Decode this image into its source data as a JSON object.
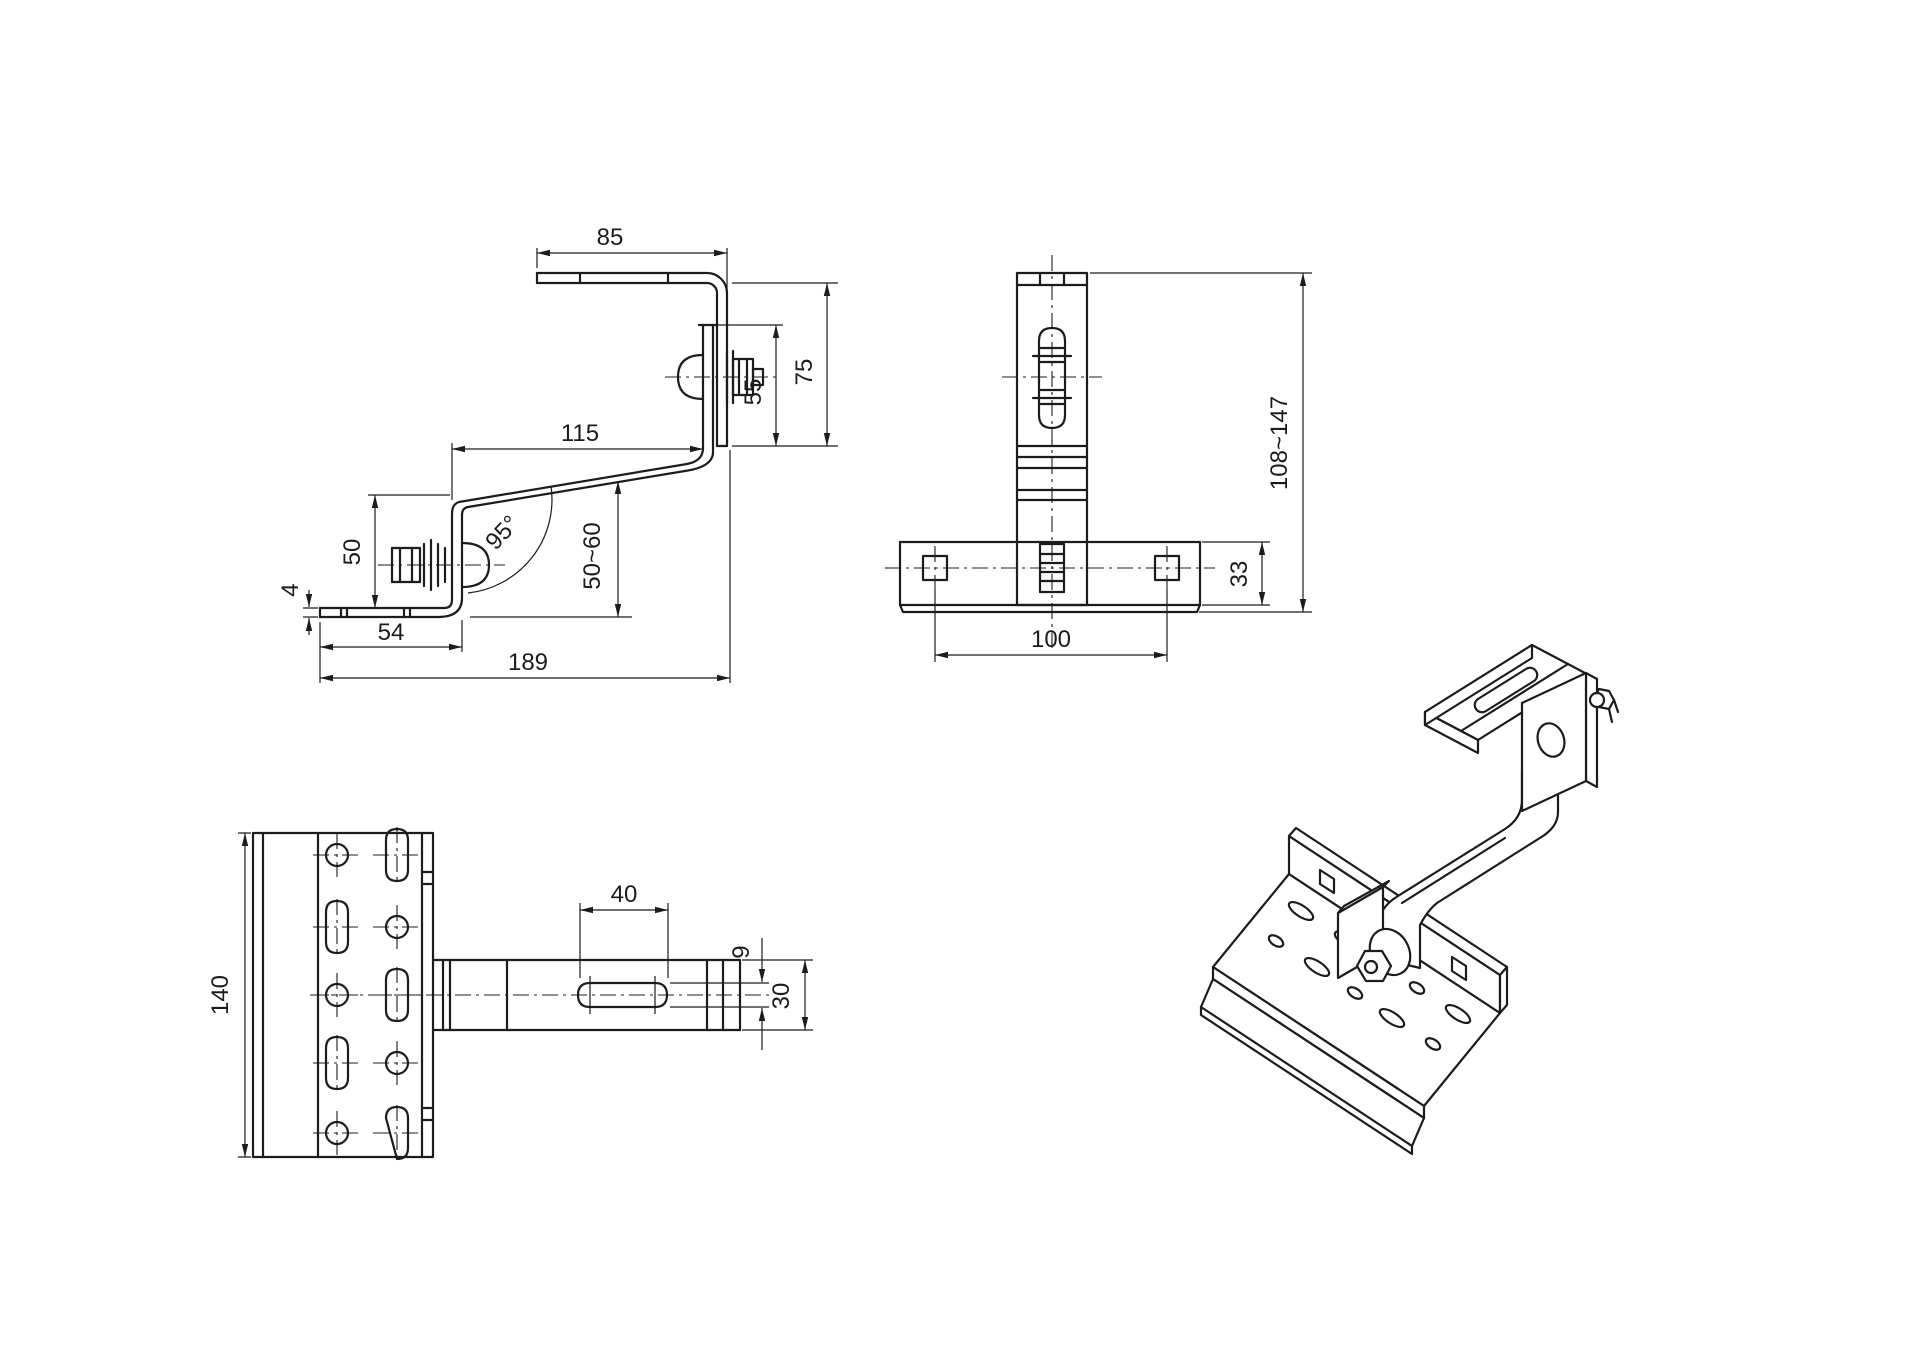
{
  "title": "roof-hook-technical-drawing",
  "colors": {
    "line": "#1c1c1c",
    "background": "#ffffff"
  },
  "dims": {
    "side": {
      "top_arm": "85",
      "upper_height": "75",
      "overlap": "55",
      "mid_arm": "115",
      "hook_height": "50",
      "angle": "95°",
      "clearance": "50~60",
      "thickness": "4",
      "base_front": "54",
      "total_length": "189"
    },
    "front": {
      "height_range": "108~147",
      "base_height": "33",
      "hole_spacing": "100"
    },
    "top": {
      "plate_width": "140",
      "slot_length": "40",
      "slot_width": "9",
      "arm_width": "30"
    }
  }
}
